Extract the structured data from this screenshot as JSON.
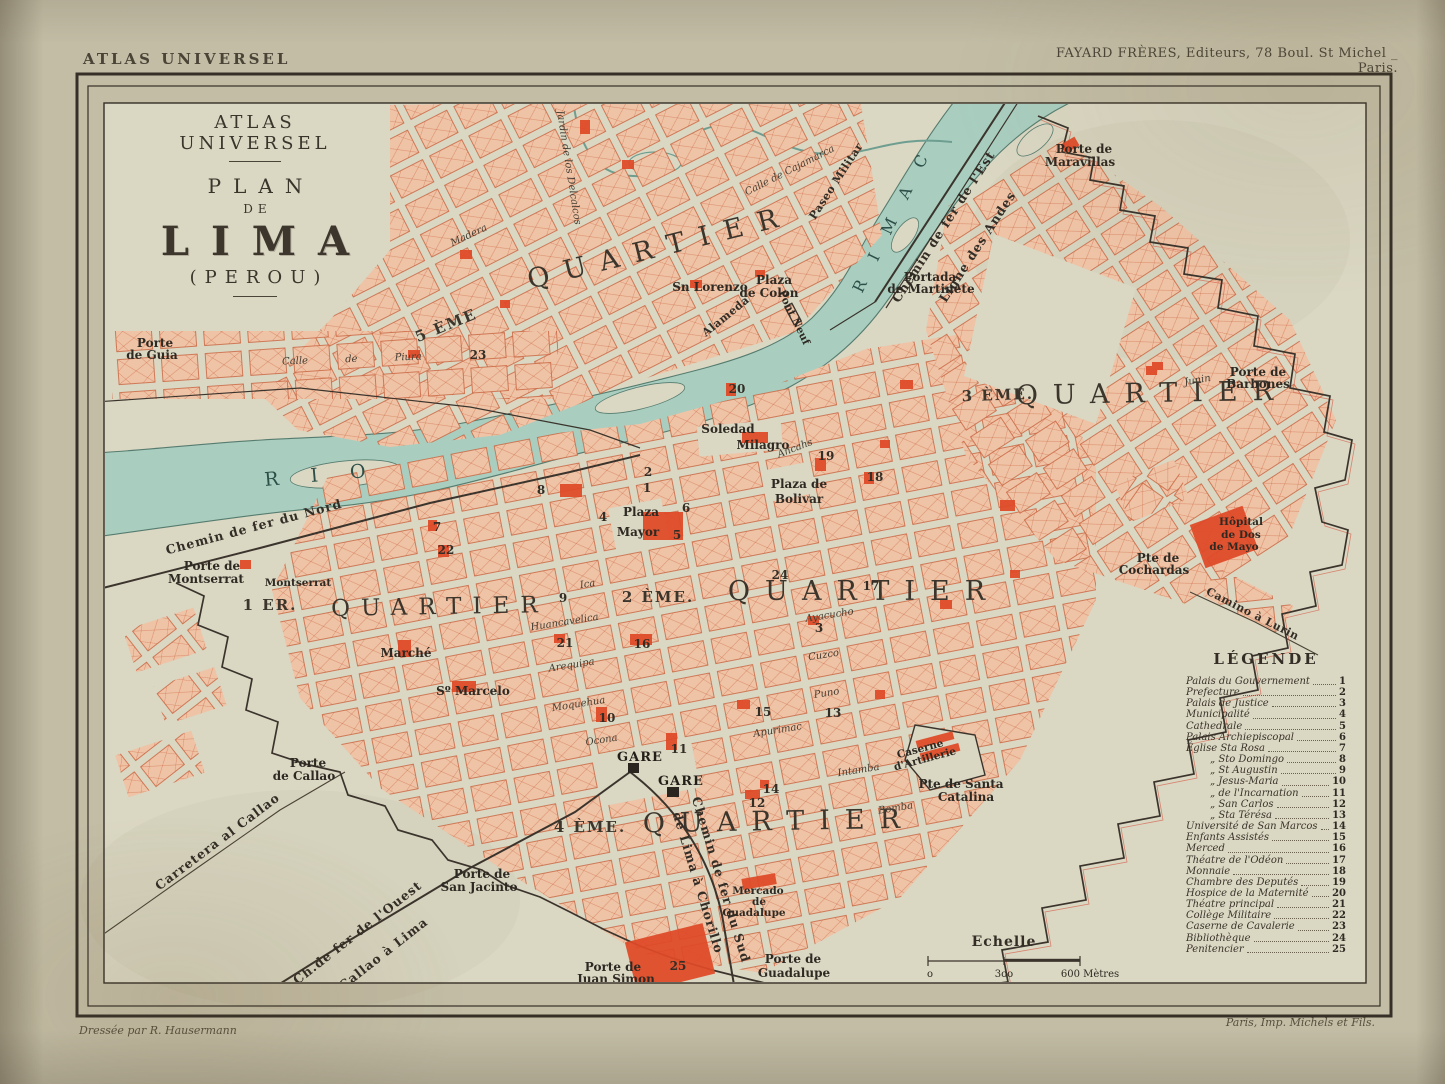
{
  "colors": {
    "paper": "#c3bda6",
    "map-paper": "#dad7c3",
    "ink": "#332d25",
    "red": "#df4a28",
    "block": "#efc3a6",
    "block-line": "#c9643f",
    "river": "#a9cec0",
    "river-line": "#567c6f"
  },
  "page": {
    "corner_label": "ATLAS UNIVERSEL",
    "publisher": "FAYARD FRÈRES, Editeurs, 78 Boul. St Michel _ Paris.",
    "credit_left": "Dressée par R. Hausermann",
    "credit_right": "Paris, Imp. Michels et Fils."
  },
  "title": {
    "series": "ATLAS UNIVERSEL",
    "plan": "PLAN",
    "de": "DE",
    "city": "LIMA",
    "country": "(PEROU)"
  },
  "quartiers": {
    "q5_num": "5 ÈME",
    "q5": "QUARTIER",
    "q3_num": "3 ÈME.",
    "q3": "QUARTIER",
    "q1_num": "1 ER.",
    "q1": "QUARTIER",
    "q2_num": "2 ÈME.",
    "q2": "QUARTIER",
    "q4_num": "4 ÈME.",
    "q4": "QUARTIER"
  },
  "river": {
    "rio": "R I O",
    "rimac": "R I M A C"
  },
  "rails": {
    "nord": "Chemin de fer du Nord",
    "est": "Chemin de fer de l'Est",
    "andes": "Ligne des Andes",
    "ouest_1": "Ch.de fer de l'Ouest",
    "ouest_2": "Callao à Lima",
    "sud_1": "Chemin de fer du Sud",
    "sud_2": "de Lima à Chorillo",
    "carretera": "Carretera al Callao",
    "lurin": "Camino à Lurin",
    "paseo": "Paseo Militar",
    "alameda": "Alameda"
  },
  "places": {
    "guia_1": "Porte",
    "guia_2": "de Guia",
    "montserrat_gate_1": "Porte de",
    "montserrat_gate_2": "Montserrat",
    "callao_1": "Porte",
    "callao_2": "de Callao",
    "san_jacinto_1": "Porte de",
    "san_jacinto_2": "San Jacinto",
    "juan_simon_1": "Porte de",
    "juan_simon_2": "Juan Simon",
    "guadalupe_1": "Porte de",
    "guadalupe_2": "Guadalupe",
    "maravillas_1": "Porte de",
    "maravillas_2": "Maravillas",
    "martinete_1": "Portada",
    "martinete_2": "de Martinete",
    "barbones_1": "Porte de",
    "barbones_2": "Barbones",
    "catalina_1": "Pte de Santa",
    "catalina_2": "Catalina",
    "cochardas_1": "Pte de",
    "cochardas_2": "Cochardas",
    "hopital_1": "Hôpital",
    "hopital_2": "de Dos",
    "hopital_3": "de Mayo",
    "sn_lorenzo": "Sn Lorenzo",
    "plaza_colon_1": "Plaza",
    "plaza_colon_2": "de Colon",
    "plaza_mayor_1": "Plaza",
    "plaza_mayor_2": "Mayor",
    "plaza_bolivar_1": "Plaza de",
    "plaza_bolivar_2": "Bolivar",
    "pont_neuf": "Pont Neuf",
    "soledad": "Soledad",
    "milagro": "Milagro",
    "montserrat": "Montserrat",
    "marche": "Marché",
    "st_marcelo": "Sº Marcelo",
    "mercado_1": "Mercado",
    "mercado_2": "de",
    "mercado_3": "Guadalupe",
    "caserne_1": "Caserne",
    "caserne_2": "d'Artillerie",
    "gare": "GARE",
    "jardin": "Jardin de los Delcalcos"
  },
  "streets": {
    "piura": "Calle de Piura",
    "cajamarca": "Calle de Cajamarca",
    "ancahs": "Ancahs",
    "madera": "Madera",
    "huancavelica": "Huancavelica",
    "arequipa": "Arequipa",
    "moquehua": "Moquehua",
    "ocona": "Ocona",
    "ica": "Ica",
    "ayacucho": "Ayacucho",
    "cuzco": "Cuzco",
    "puno": "Puno",
    "apurimac": "Apurimac",
    "intamba": "Intamba",
    "bomba": "Bomba",
    "junin": "Junin"
  },
  "numbers": {
    "n1": "1",
    "n2": "2",
    "n3": "3",
    "n4": "4",
    "n5": "5",
    "n6": "6",
    "n7": "7",
    "n8": "8",
    "n9": "9",
    "n10": "10",
    "n11": "11",
    "n12": "12",
    "n13": "13",
    "n14": "14",
    "n15": "15",
    "n16": "16",
    "n17": "17",
    "n18": "18",
    "n19": "19",
    "n20": "20",
    "n21": "21",
    "n22": "22",
    "n23": "23",
    "n24": "24",
    "n25": "25"
  },
  "scale": {
    "title": "Echelle",
    "t0": "o",
    "t300": "3oo",
    "t600": "600 Mètres"
  },
  "legend": {
    "title": "LÉGENDE",
    "entries": [
      {
        "name": "Palais du Gouvernement",
        "num": "1",
        "cls": ""
      },
      {
        "name": "Prefecture",
        "num": "2",
        "cls": ""
      },
      {
        "name": "Palais de Justice",
        "num": "3",
        "cls": ""
      },
      {
        "name": "Municipalité",
        "num": "4",
        "cls": ""
      },
      {
        "name": "Cathedrale",
        "num": "5",
        "cls": ""
      },
      {
        "name": "Palais Archiepiscopal",
        "num": "6",
        "cls": ""
      },
      {
        "name": "Église Sta Rosa",
        "num": "7",
        "cls": ""
      },
      {
        "name": "„ Sto Domingo",
        "num": "8",
        "cls": "indent"
      },
      {
        "name": "„ St Augustin",
        "num": "9",
        "cls": "indent"
      },
      {
        "name": "„ Jesus-Maria",
        "num": "10",
        "cls": "indent"
      },
      {
        "name": "„ de l'Incarnation",
        "num": "11",
        "cls": "indent"
      },
      {
        "name": "„ San Carlos",
        "num": "12",
        "cls": "indent"
      },
      {
        "name": "„ Sta Térésa",
        "num": "13",
        "cls": "indent"
      },
      {
        "name": "Université de San Marcos",
        "num": "14",
        "cls": ""
      },
      {
        "name": "Enfants Assistés",
        "num": "15",
        "cls": ""
      },
      {
        "name": "Merced",
        "num": "16",
        "cls": ""
      },
      {
        "name": "Théatre de l'Odéon",
        "num": "17",
        "cls": ""
      },
      {
        "name": "Monnaie",
        "num": "18",
        "cls": ""
      },
      {
        "name": "Chambre des Deputés",
        "num": "19",
        "cls": ""
      },
      {
        "name": "Hospice de la Maternité",
        "num": "20",
        "cls": ""
      },
      {
        "name": "Théatre principal",
        "num": "21",
        "cls": ""
      },
      {
        "name": "Collège Militaire",
        "num": "22",
        "cls": ""
      },
      {
        "name": "Caserne de Cavalerie",
        "num": "23",
        "cls": ""
      },
      {
        "name": "Bibliothèque",
        "num": "24",
        "cls": ""
      },
      {
        "name": "Penitencier",
        "num": "25",
        "cls": ""
      }
    ]
  }
}
